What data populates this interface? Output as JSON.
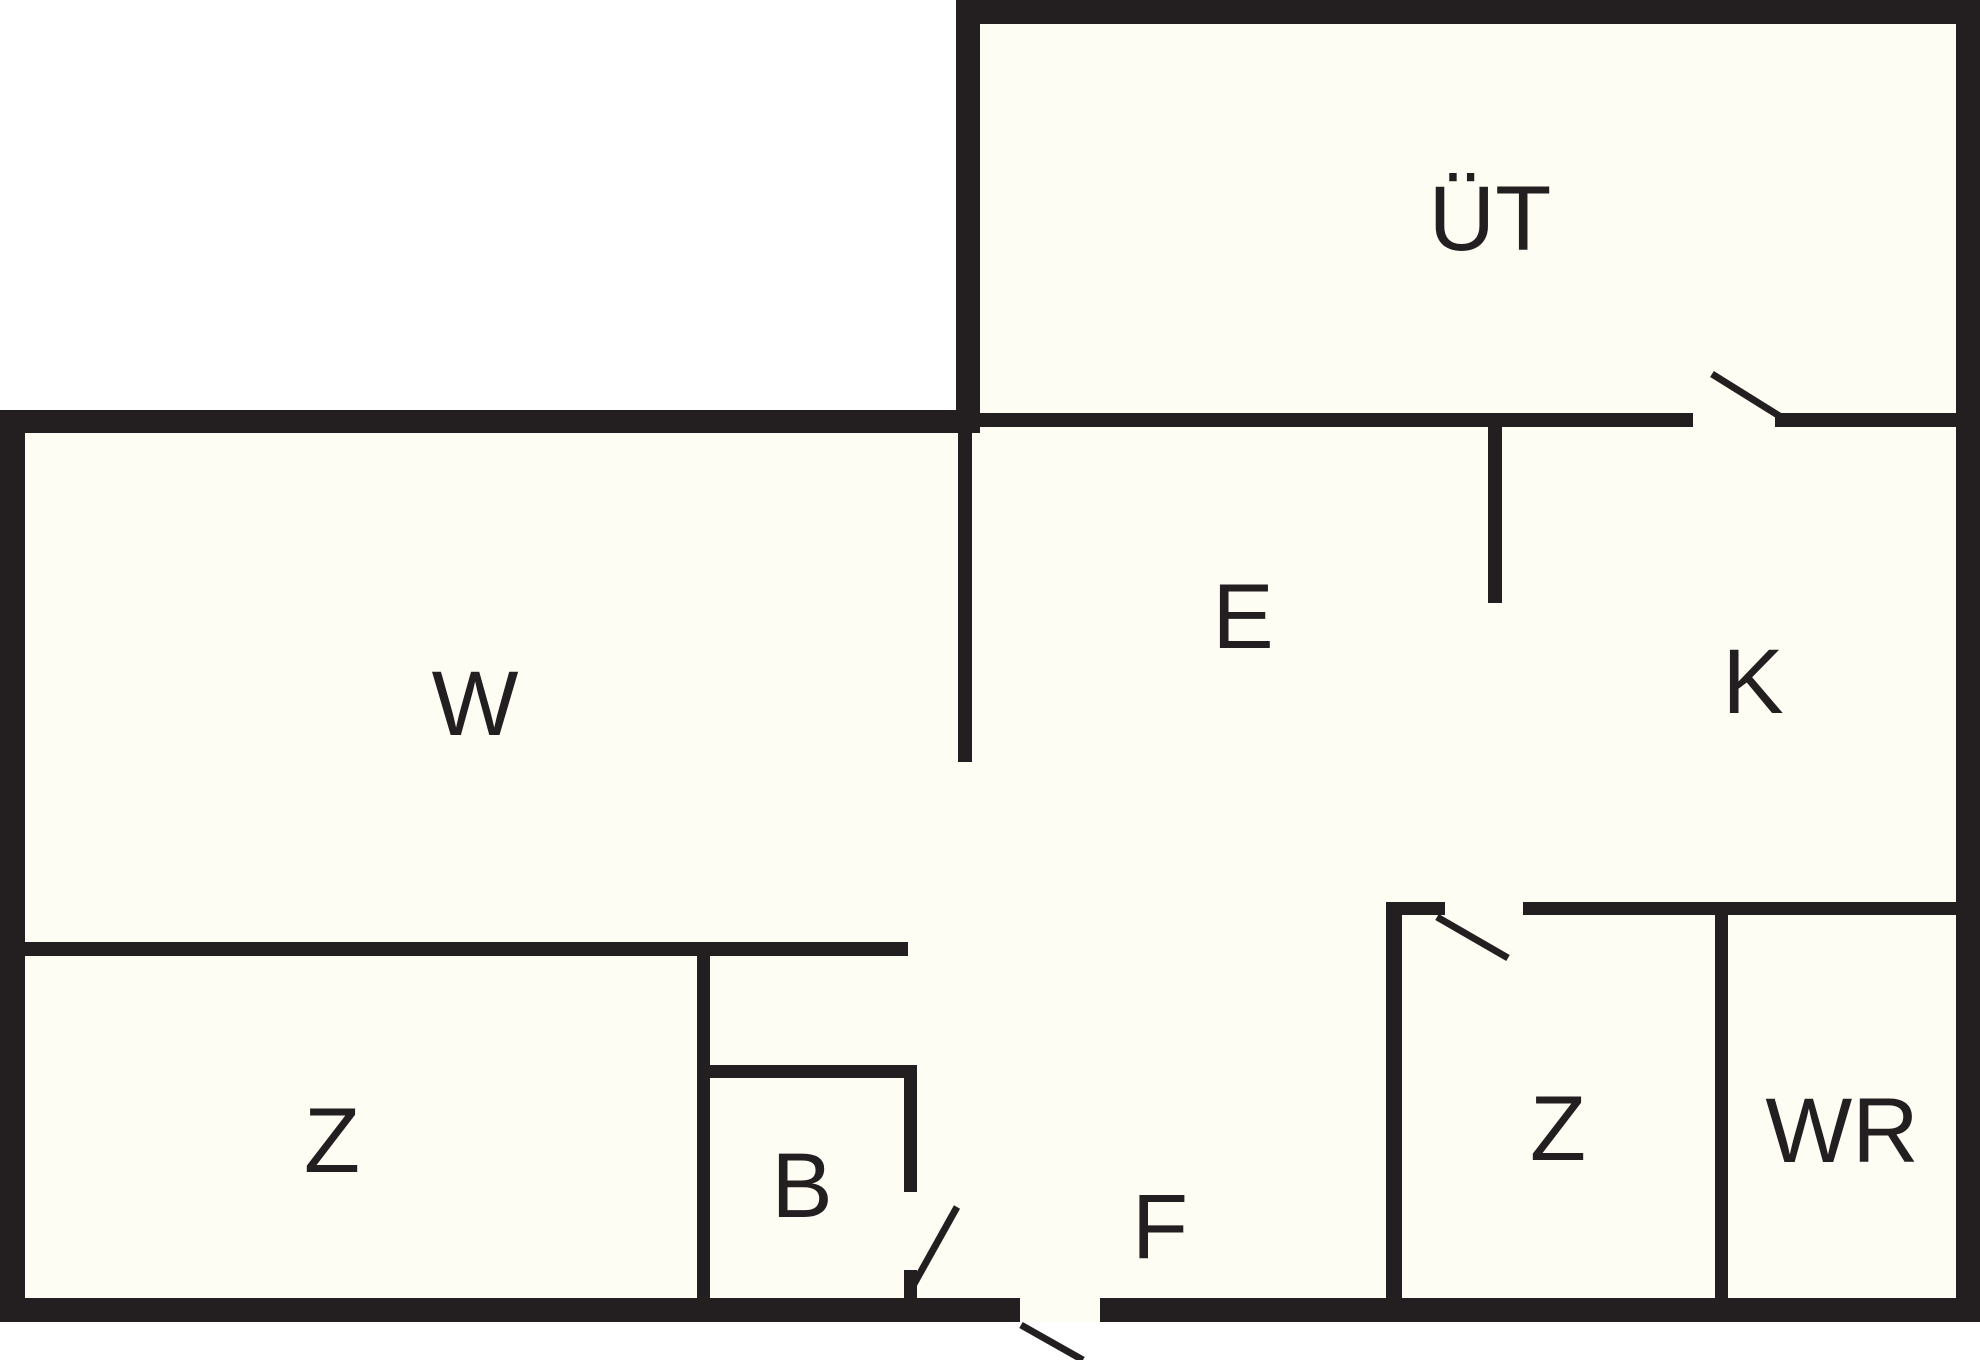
{
  "document": {
    "type": "floor-plan-drawing",
    "background_outside": "#ffffff"
  },
  "colors": {
    "wall": "#231f20",
    "interior": "#fdfdf3",
    "label": "#231f20",
    "door_swing": "#231f20"
  },
  "canvas": {
    "width": 1980,
    "height": 1360
  },
  "floorplan": {
    "interior_regions": [
      {
        "name": "ut-room-floor",
        "x": 980,
        "y": 24,
        "w": 976,
        "h": 403
      },
      {
        "name": "main-body-floor",
        "x": 25,
        "y": 427,
        "w": 1931,
        "h": 871
      }
    ],
    "walls": [
      {
        "name": "ut-top-outer-wall",
        "x": 956,
        "y": 0,
        "w": 1024,
        "h": 24
      },
      {
        "name": "ut-left-outer-wall",
        "x": 956,
        "y": 0,
        "w": 24,
        "h": 433
      },
      {
        "name": "right-outer-wall",
        "x": 1956,
        "y": 0,
        "w": 24,
        "h": 1322
      },
      {
        "name": "top-left-outer-wall",
        "x": 0,
        "y": 410,
        "w": 980,
        "h": 23
      },
      {
        "name": "left-outer-wall",
        "x": 0,
        "y": 410,
        "w": 25,
        "h": 912
      },
      {
        "name": "bottom-outer-wall-left",
        "x": 0,
        "y": 1298,
        "w": 1020,
        "h": 24
      },
      {
        "name": "bottom-outer-wall-right",
        "x": 1100,
        "y": 1298,
        "w": 880,
        "h": 24
      },
      {
        "name": "ut-bottom-wall-left-seg",
        "x": 980,
        "y": 413,
        "w": 713,
        "h": 14
      },
      {
        "name": "ut-bottom-wall-right-seg",
        "x": 1775,
        "y": 413,
        "w": 181,
        "h": 14
      },
      {
        "name": "w-e-divider-wall",
        "x": 958,
        "y": 427,
        "w": 14,
        "h": 335
      },
      {
        "name": "e-k-divider-wall",
        "x": 1488,
        "y": 427,
        "w": 14,
        "h": 176
      },
      {
        "name": "w-z-divider-wall",
        "x": 25,
        "y": 942,
        "w": 883,
        "h": 14
      },
      {
        "name": "z-b-divider-wall",
        "x": 697,
        "y": 956,
        "w": 13,
        "h": 342
      },
      {
        "name": "b-top-wall",
        "x": 710,
        "y": 1065,
        "w": 207,
        "h": 13
      },
      {
        "name": "b-right-wall-upper",
        "x": 904,
        "y": 1065,
        "w": 13,
        "h": 127
      },
      {
        "name": "b-right-wall-stub",
        "x": 904,
        "y": 1270,
        "w": 13,
        "h": 28
      },
      {
        "name": "k-bottom-wall-stub",
        "x": 1386,
        "y": 902,
        "w": 59,
        "h": 13
      },
      {
        "name": "k-bottom-wall-main",
        "x": 1523,
        "y": 902,
        "w": 433,
        "h": 13
      },
      {
        "name": "z2-left-wall",
        "x": 1386,
        "y": 902,
        "w": 16,
        "h": 396
      },
      {
        "name": "z2-wr-divider-wall",
        "x": 1715,
        "y": 915,
        "w": 13,
        "h": 383
      }
    ],
    "door_gap_fills": [
      {
        "name": "entry-door-threshold",
        "x": 1020,
        "y": 1298,
        "w": 80,
        "h": 24
      }
    ],
    "door_swings": [
      {
        "name": "ut-door-swing",
        "x1": 1712,
        "y1": 374,
        "x2": 1781,
        "y2": 417
      },
      {
        "name": "z2-door-swing",
        "x1": 1437,
        "y1": 917,
        "x2": 1508,
        "y2": 958
      },
      {
        "name": "b-door-swing",
        "x1": 957,
        "y1": 1207,
        "x2": 914,
        "y2": 1284
      },
      {
        "name": "entry-door-swing",
        "x1": 1021,
        "y1": 1325,
        "x2": 1083,
        "y2": 1360
      }
    ],
    "rooms": [
      {
        "id": "ut",
        "label": "ÜT",
        "x": 1490,
        "y": 250
      },
      {
        "id": "w",
        "label": "W",
        "x": 475,
        "y": 735
      },
      {
        "id": "e",
        "label": "E",
        "x": 1243,
        "y": 648
      },
      {
        "id": "k",
        "label": "K",
        "x": 1753,
        "y": 713
      },
      {
        "id": "z1",
        "label": "Z",
        "x": 332,
        "y": 1172
      },
      {
        "id": "b",
        "label": "B",
        "x": 802,
        "y": 1217
      },
      {
        "id": "f",
        "label": "F",
        "x": 1160,
        "y": 1258
      },
      {
        "id": "z2",
        "label": "Z",
        "x": 1558,
        "y": 1160
      },
      {
        "id": "wr",
        "label": "WR",
        "x": 1842,
        "y": 1162
      }
    ],
    "label_font_size": 92,
    "door_swing_stroke": 7
  }
}
